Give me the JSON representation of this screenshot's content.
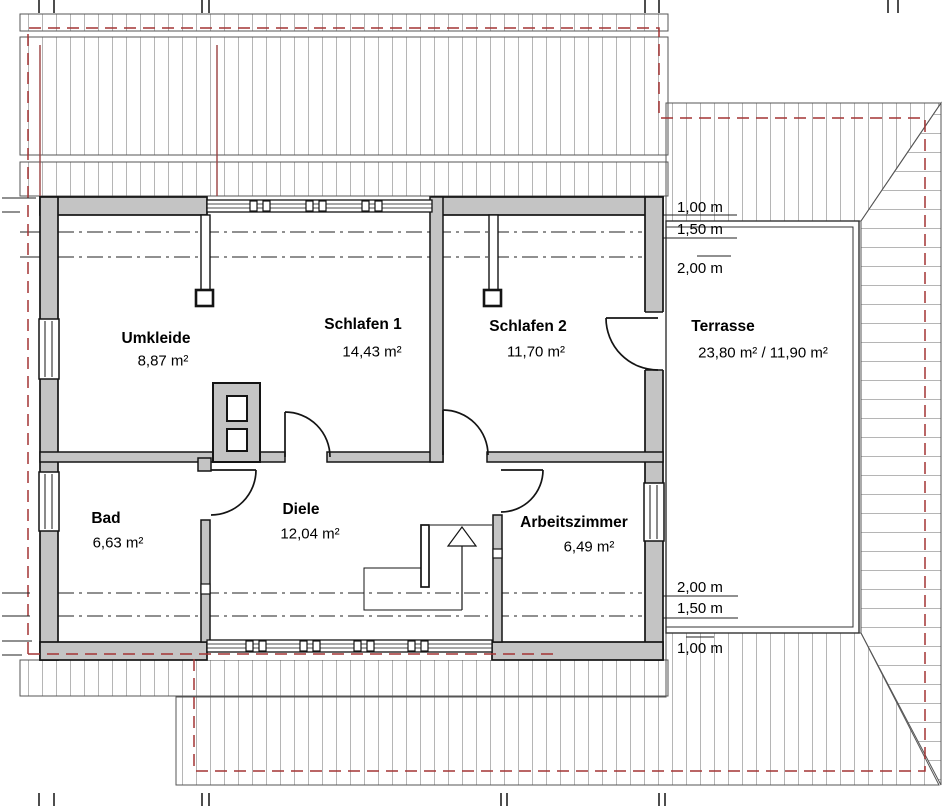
{
  "rooms": {
    "umkleide": {
      "name": "Umkleide",
      "area": "8,87 m²"
    },
    "schlafen1": {
      "name": "Schlafen 1",
      "area": "14,43 m²"
    },
    "schlafen2": {
      "name": "Schlafen 2",
      "area": "11,70 m²"
    },
    "bad": {
      "name": "Bad",
      "area": "6,63 m²"
    },
    "diele": {
      "name": "Diele",
      "area": "12,04 m²"
    },
    "arbeitszimmer": {
      "name": "Arbeitszimmer",
      "area": "6,49 m²"
    },
    "terrasse": {
      "name": "Terrasse",
      "area": "23,80 m² / 11,90 m²"
    }
  },
  "roof_height_lines": {
    "top": {
      "h100": "1,00 m",
      "h150": "1,50 m",
      "h200": "2,00 m"
    },
    "bottom": {
      "h200": "2,00 m",
      "h150": "1,50 m",
      "h100": "1,00 m"
    }
  },
  "colors": {
    "wall_fill": "#c4c4c4",
    "line": "#141414",
    "hatch": "#b5b5b5",
    "roof_outline_dashed": "#a33434",
    "roof_marker_solid": "#994040",
    "background": "#ffffff"
  }
}
